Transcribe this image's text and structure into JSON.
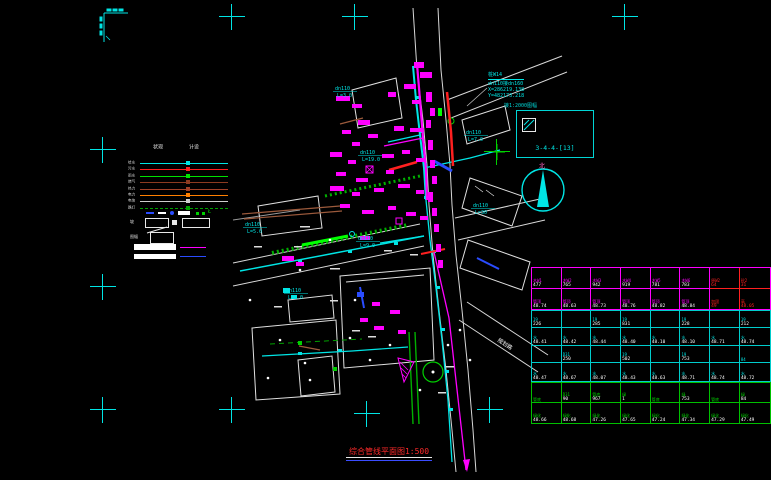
{
  "canvas": {
    "width": 771,
    "height": 480,
    "background": "#000000"
  },
  "colors": {
    "cyan": "#00e5e5",
    "magenta": "#ff00ff",
    "red": "#ff2020",
    "green": "#00d000",
    "white": "#ffffff",
    "orange": "#ff8000",
    "brown": "#9c5a3c",
    "blue": "#2a4cff"
  },
  "crosses": {
    "cyan": [
      [
        232,
        17
      ],
      [
        355,
        17
      ],
      [
        625,
        17
      ],
      [
        103,
        150
      ],
      [
        103,
        287
      ],
      [
        103,
        410
      ],
      [
        232,
        410
      ],
      [
        367,
        414
      ],
      [
        490,
        410
      ]
    ],
    "green": [
      [
        497,
        152
      ]
    ]
  },
  "coord_note": {
    "line1": "桩W14",
    "line2": "dn110接dn160",
    "line3": "X=286219.138",
    "line4": "Y=482173.218"
  },
  "detail_box": {
    "title": "接1:2000图幅",
    "code": "3-4-4-[13]"
  },
  "north": {
    "label": "北"
  },
  "legend": {
    "col_headers": [
      "现状",
      "设计"
    ],
    "rows": [
      {
        "label": "给水",
        "color": "#00e5e5",
        "dashed": false
      },
      {
        "label": "污水",
        "color": "#ff2020",
        "dashed": false
      },
      {
        "label": "雨水",
        "color": "#00e000",
        "dashed": false
      },
      {
        "label": "燃气",
        "color": "#8c3a20",
        "dashed": false
      },
      {
        "label": "热力",
        "color": "#a04028",
        "dashed": false
      },
      {
        "label": "电力",
        "color": "#ff8000",
        "dashed": false
      },
      {
        "label": "电信",
        "color": "#cfcfcf",
        "dashed": false
      },
      {
        "label": "路灯",
        "color": "#00a000",
        "dashed": true
      }
    ],
    "misc": {
      "slope_label": "坡",
      "sheet_label": "图幅",
      "sheet_value": "A4"
    }
  },
  "map": {
    "labels": [
      {
        "text": "dn110",
        "sub": "L=3.0",
        "x": 335,
        "y": 90
      },
      {
        "text": "dn110",
        "sub": "L=19.0",
        "x": 360,
        "y": 154
      },
      {
        "text": "dn110",
        "sub": "L=5.0",
        "x": 245,
        "y": 226
      },
      {
        "text": "dn110",
        "sub": "L=9.0",
        "x": 358,
        "y": 240
      },
      {
        "text": "dn110",
        "sub": "L=7.0",
        "x": 466,
        "y": 134
      },
      {
        "text": "dn110",
        "sub": "L=30",
        "x": 473,
        "y": 207
      },
      {
        "text": "dn110",
        "sub": "L=2.0",
        "x": 286,
        "y": 292
      }
    ],
    "road_label": "规划路"
  },
  "table": {
    "sections": [
      {
        "border": "#ff00ff",
        "label_color": "#ff00ff",
        "value_color": "#ffffff",
        "red_cols": [
          6,
          7
        ],
        "rows": [
          {
            "h": 21,
            "cells": [
              "木W1|477",
              "木W2|765",
              "木W3|942",
              "木W4|919",
              "木W5|781",
              "木W6|783",
              "原W2|64",
              "砼2|31"
            ]
          },
          {
            "h": 20,
            "cells": [
              "管顶|48.74",
              "管顶|48.63",
              "管顶|48.73",
              "管顶|48.76",
              "管顶|48.82",
              "管顶|48.84",
              "加固|49",
              "高|48.05"
            ]
          }
        ]
      },
      {
        "border": "#00cccc",
        "label_color": "#00e5e5",
        "value_color": "#ffffff",
        "red_cols": [],
        "rows": [
          {
            "h": 17,
            "cells": [
              "19|226",
              "|",
              "19|285",
              "19|831",
              "|",
              "19|228",
              "|",
              "19|212"
            ]
          },
          {
            "h": 18,
            "cells": [
              "水|48.41",
              "水|48.42",
              "水|48.44",
              "水|48.40",
              "水|48.10",
              "水|48.10",
              "水|48.71",
              "水|48.74"
            ]
          },
          {
            "h": 17,
            "cells": [
              "|",
              "D31|250",
              "|",
              "19|502",
              "|",
              "19|753",
              "|",
              "84|"
            ]
          },
          {
            "h": 18,
            "cells": [
              "水|48.47",
              "水|48.67",
              "水|48.07",
              "水|48.43",
              "水|48.63",
              "水|48.71",
              "水|48.74",
              "水|48.72"
            ]
          }
        ]
      },
      {
        "border": "#00c000",
        "label_color": "#00d000",
        "value_color": "#ffffff",
        "red_cols": [],
        "rows": [
          {
            "h": 20,
            "cells": [
              "管底|",
              "D31|90",
              "管底|967",
              "绿|1",
              "管底|",
              "绿|753",
              "管底|",
              "绿|84"
            ]
          },
          {
            "h": 20,
            "cells": [
              "绿化|48.66",
              "绿化|48.68",
              "绿化|47.26",
              "绿化|47.65",
              "绿化|47.24",
              "绿化|47.34",
              "绿化|47.29",
              "绿化|47.49"
            ]
          }
        ]
      }
    ]
  },
  "title": {
    "text": "综合管线平面图",
    "scale": "1:500"
  }
}
